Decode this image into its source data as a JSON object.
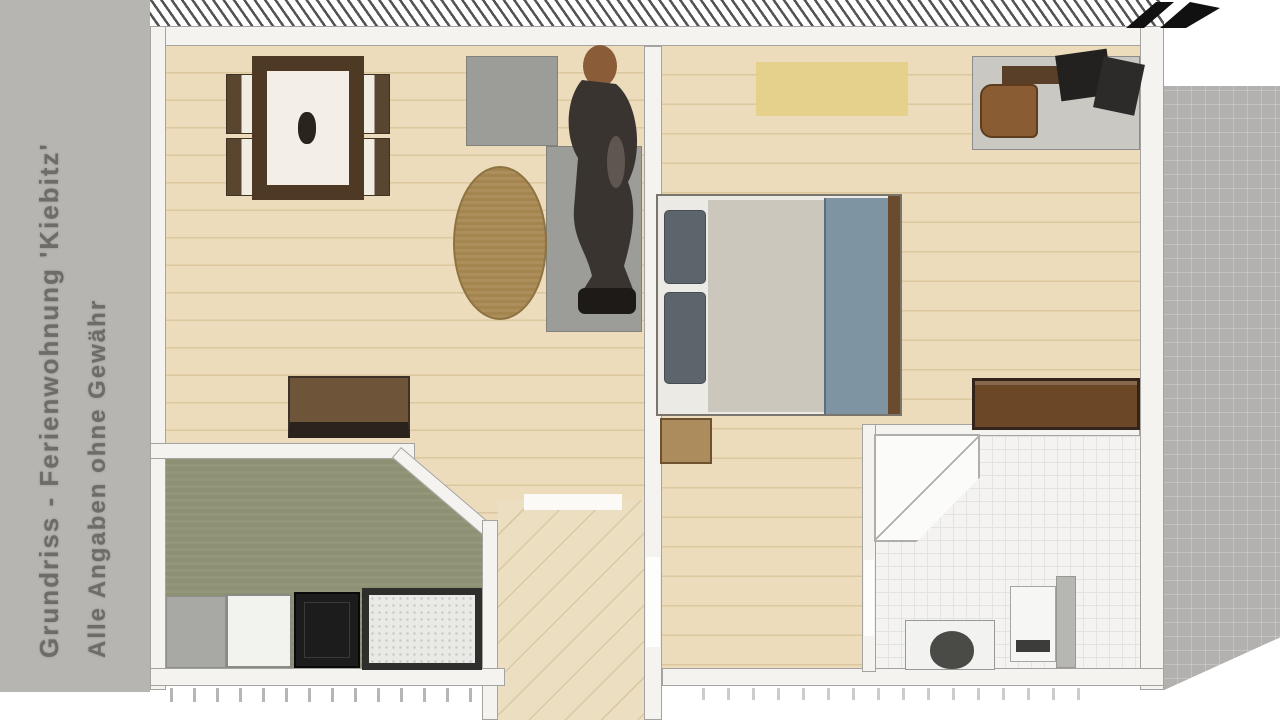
{
  "caption": {
    "line1": "Grundriss - Ferienwohnung 'Kiebitz'",
    "line2": "Alle Angaben ohne Gewähr"
  },
  "icons": {
    "north_arrow": "north-arrow"
  },
  "colors": {
    "marginGray": "#b7b5b2",
    "rightGray": "#b3b1af",
    "textGray": "#6e6c68",
    "wallWhite": "#f5f3ef",
    "wallEdge": "#a5a3a0",
    "woodFloor": "#ecdcbb",
    "plankLine": "#dcc79f",
    "hallFloor": "#ecdec0",
    "kitchenFloor": "#8d9072",
    "bathFloor": "#f4f3f1",
    "bathGrid": "#e3e3e1",
    "tableBrown": "#4e3a24",
    "chairWood": "#5a4530",
    "sofaGray": "#9c9c98",
    "rugBrown": "#a5854e",
    "sideboardBrown": "#6e553a",
    "counterGray": "#a8a8a4",
    "applianceWhite": "#f2f2ee",
    "stoveBlack": "#1c1c1c",
    "yellowRug": "#e5d08c",
    "deskTop": "#cac8c2",
    "deskBar": "#5a3f28",
    "chairBrown": "#8a5c34",
    "mattress": "#ccc7bd",
    "blanket": "#7e94a2",
    "pillowGray": "#5c646c",
    "bedFoot": "#6a4b2e",
    "nightstand": "#ac8c5c",
    "dresserBrown": "#6b4726",
    "personDark": "#3a3430",
    "personHead": "#8a5c38"
  }
}
